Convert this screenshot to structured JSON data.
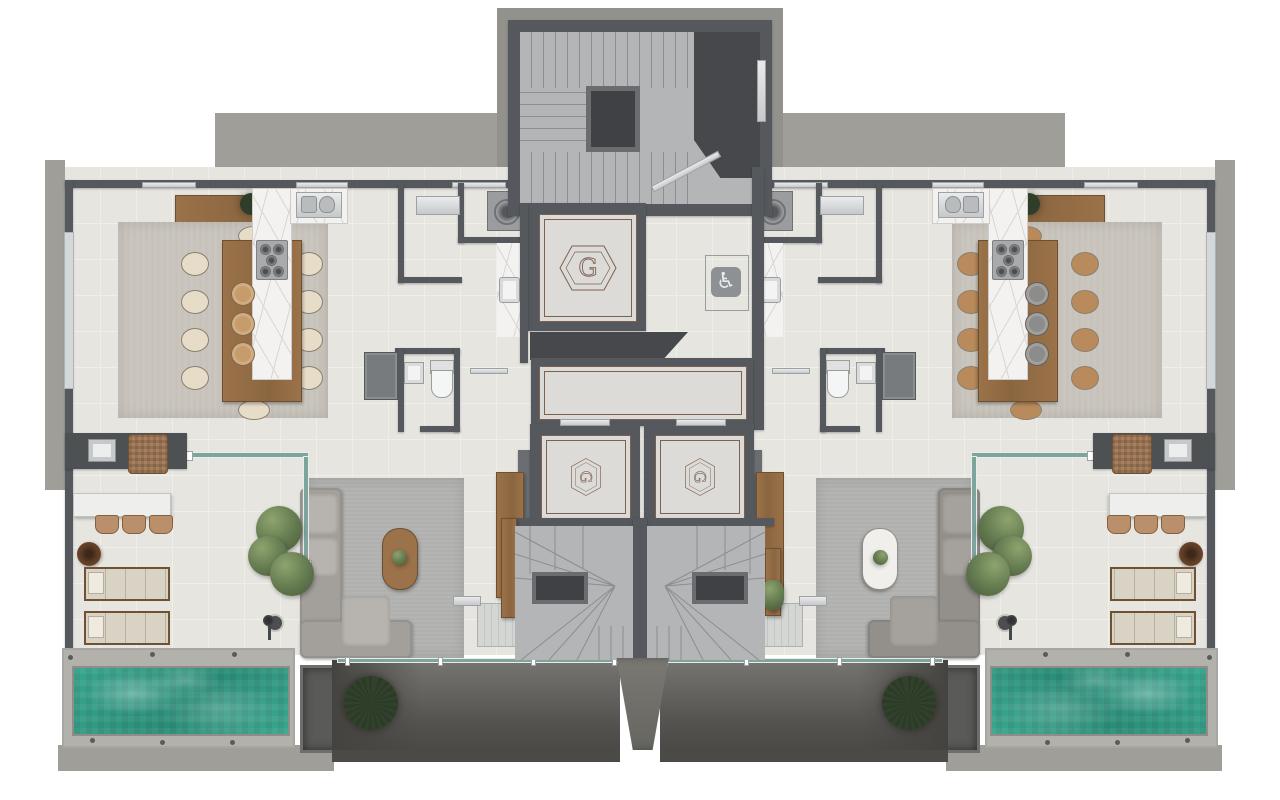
{
  "scene": {
    "kind": "architectural floor plan, top-down 3D render",
    "units": [
      "left apartment",
      "right apartment (mirrored)"
    ],
    "core": [
      "main stairwell",
      "three elevators",
      "elevator lobby",
      "accessible corridor",
      "twin winder stairs",
      "entry ramp pier"
    ]
  },
  "glyphs": {
    "elevator_monogram": "G",
    "accessible_symbol": "♿"
  },
  "palette": {
    "concrete": "#9f9e99",
    "concrete2": "#92918c",
    "wall": "#55585c",
    "wall-light": "#6a6d71",
    "core-dark": "#46484b",
    "stair": "#b3b5b7",
    "stair-line": "#8b8d90",
    "floor": "#e7e5e0",
    "grout": "#f0eee9",
    "elev-floor": "#dcdbd8",
    "bronze": "#7d6050",
    "marble": "#f3f2f0",
    "vein": "#d8d6d3",
    "wood": "#9b7249",
    "wood-dark": "#6f4f30",
    "rug-dining": "#c7c3bb",
    "rug-living": "#b0b1ae",
    "steel": "#c6c8ca",
    "glass": "#7fa49c",
    "pool": "#2f9a84",
    "deck": "#b2b1ac",
    "white-furn": "#eeefed",
    "lounger": "#d9d3c5",
    "tree": "#63794f",
    "palm": "#2c3b27",
    "ramp": "#6f6e69",
    "under1": "#777571",
    "under2": "#4b4946",
    "chairc": "#e6dcc8",
    "stoolc": "#c59c6a",
    "sofac": "#a39f9a",
    "sofapad": "#b7b3ae",
    "ctc": "#9b7249",
    "rattan": "#a8805e"
  }
}
